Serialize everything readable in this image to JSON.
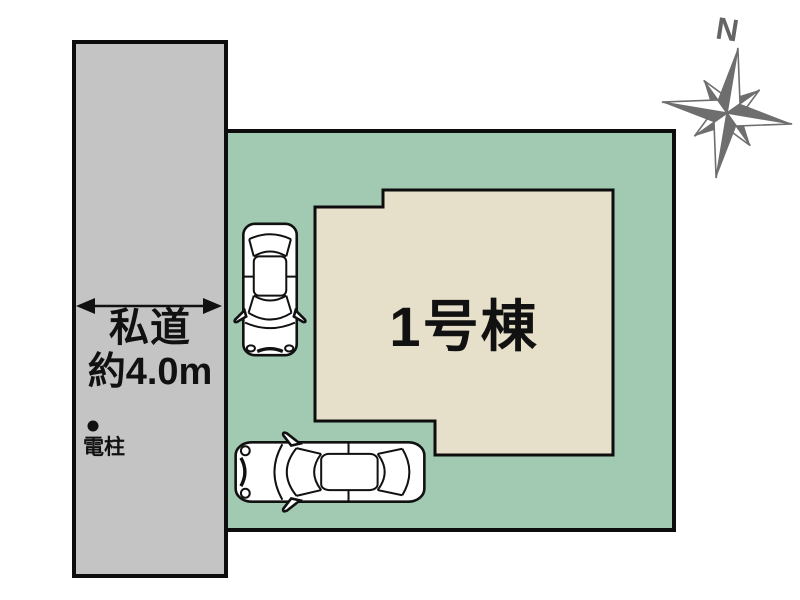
{
  "site_plan": {
    "road": {
      "label_line1": "私道",
      "label_line2": "約4.0m",
      "pole_label": "電柱",
      "fill": "#c4c4c4"
    },
    "lot": {
      "fill": "#a2c9b2"
    },
    "building": {
      "label": "1号棟",
      "fill": "#e6dfc9"
    },
    "compass": {
      "north_label": "N",
      "color": "#6e6e6e"
    },
    "outline_color": "#0d0d0d"
  }
}
